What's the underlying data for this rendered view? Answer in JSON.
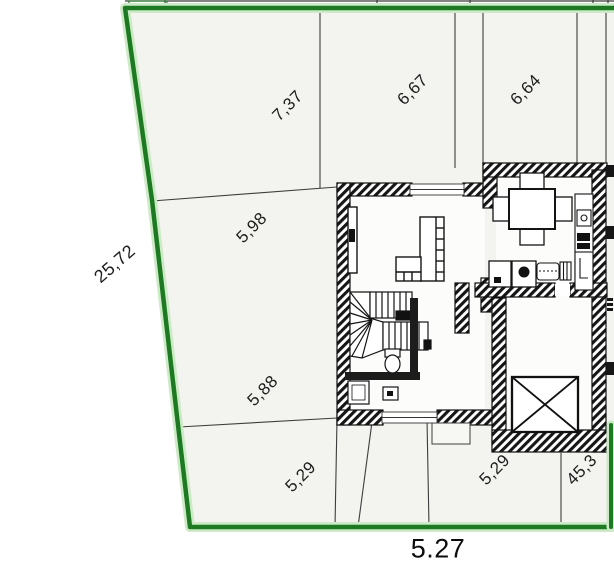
{
  "plan": {
    "title": "site-and-floor-plan",
    "dimensions": {
      "boundary_left": "25,72",
      "top": [
        "7,37",
        "6,67",
        "6,64"
      ],
      "left": [
        "5,98",
        "5,88"
      ],
      "bottom": [
        "5,29",
        "5,29",
        "45,3"
      ],
      "total_bottom": "5.27"
    },
    "colors": {
      "boundary_green": "#1e7a22",
      "boundary_halo": "#cdeac6",
      "site_fill": "#f3f3ef",
      "wall_ink": "#161616",
      "divider": "#3d3d3d",
      "label_ink": "#1d1d1d"
    }
  }
}
